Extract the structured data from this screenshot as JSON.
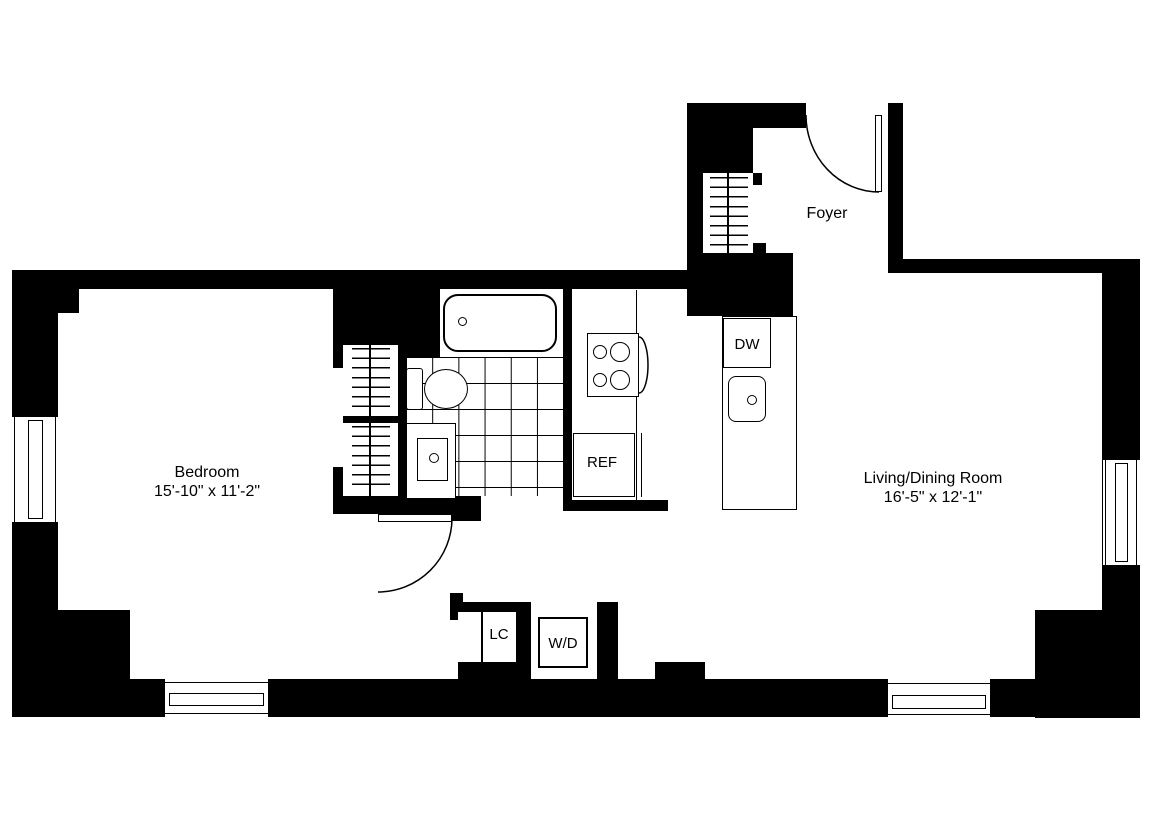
{
  "title": "Apartment floor plan",
  "rooms": {
    "foyer": {
      "label": "Foyer"
    },
    "bedroom": {
      "label": "Bedroom",
      "dimensions": "15'-10\" x 11'-2\""
    },
    "living_dining": {
      "label": "Living/Dining Room",
      "dimensions": "16'-5\" x 12'-1\""
    }
  },
  "appliances": {
    "dishwasher": "DW",
    "refrigerator": "REF",
    "linen_closet": "LC",
    "washer_dryer": "W/D"
  },
  "fixtures": [
    "bathtub",
    "toilet",
    "vanity-sink",
    "stove",
    "kitchen-island",
    "island-sink",
    "entry-door",
    "bedroom-door",
    "closet-shelves",
    "windows"
  ],
  "colors": {
    "wall": "#000000",
    "floor": "#ffffff",
    "line": "#000000"
  }
}
